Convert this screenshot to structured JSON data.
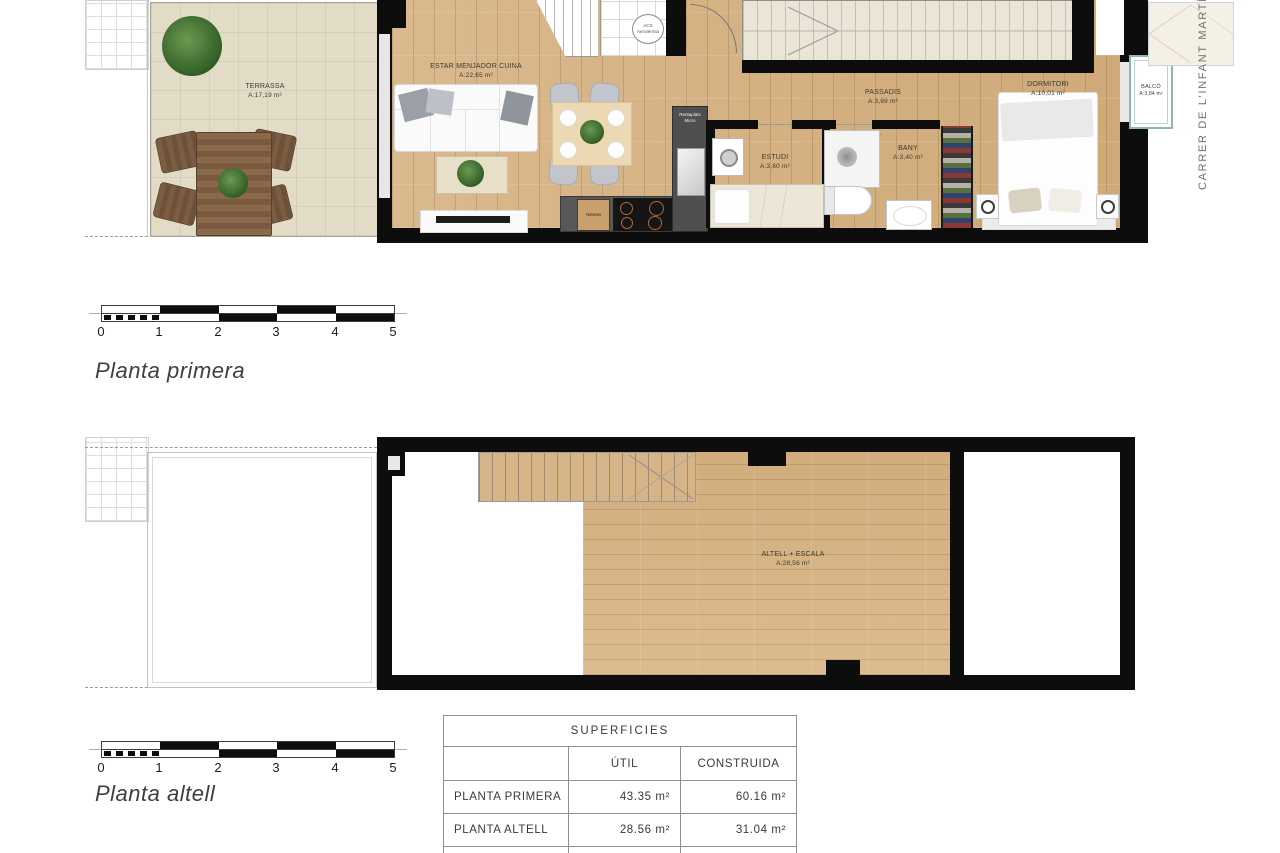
{
  "street_label": "CARRER DE L'INFANT MARTÍ",
  "floor_plans": {
    "primera": {
      "title": "Planta primera",
      "rooms": {
        "terrassa": {
          "label": "TERRASSA",
          "area": "A:17,19 m²"
        },
        "estar": {
          "label": "ESTAR MENJADOR CUINA",
          "area": "A:22,65 m²"
        },
        "estudi": {
          "label": "ESTUDI",
          "area": "A:3,60 m²"
        },
        "bany": {
          "label": "BANY",
          "area": "A:3,40 m²"
        },
        "passadis": {
          "label": "PASSADIS",
          "area": "A:3,69 m²"
        },
        "dormitori": {
          "label": "DORMITORI",
          "area": "A:10,01 m²"
        },
        "balco": {
          "label": "BALCÓ",
          "area": "A:3,84 m²"
        }
      },
      "fixtures": {
        "acs_line1": "ACS",
        "acs_line2": "Aerotèrmia",
        "rentaplats_line1": "Rentaplats",
        "rentaplats_line2": "Micro",
        "nevera": "Nevera"
      }
    },
    "altell": {
      "title": "Planta altell",
      "rooms": {
        "altell": {
          "label": "ALTELL + ESCALA",
          "area": "A:28,56 m²"
        }
      }
    }
  },
  "scale_bar": {
    "ticks": [
      "0",
      "1",
      "2",
      "3",
      "4",
      "5"
    ]
  },
  "surfaces_table": {
    "title": "SUPERFICIES",
    "col_util": "ÚTIL",
    "col_construida": "CONSTRUIDA",
    "rows": [
      {
        "name": "PLANTA PRIMERA",
        "util": "43.35 m²",
        "construida": "60.16 m²"
      },
      {
        "name": "PLANTA ALTELL",
        "util": "28.56 m²",
        "construida": "31.04 m²"
      }
    ]
  },
  "colors": {
    "wood": "#d4b083",
    "terrace_tile": "#e2dbc5",
    "wall": "#0d0d0d",
    "kitchen_counter": "#585858",
    "balcony_outline": "#8fb6b2"
  }
}
